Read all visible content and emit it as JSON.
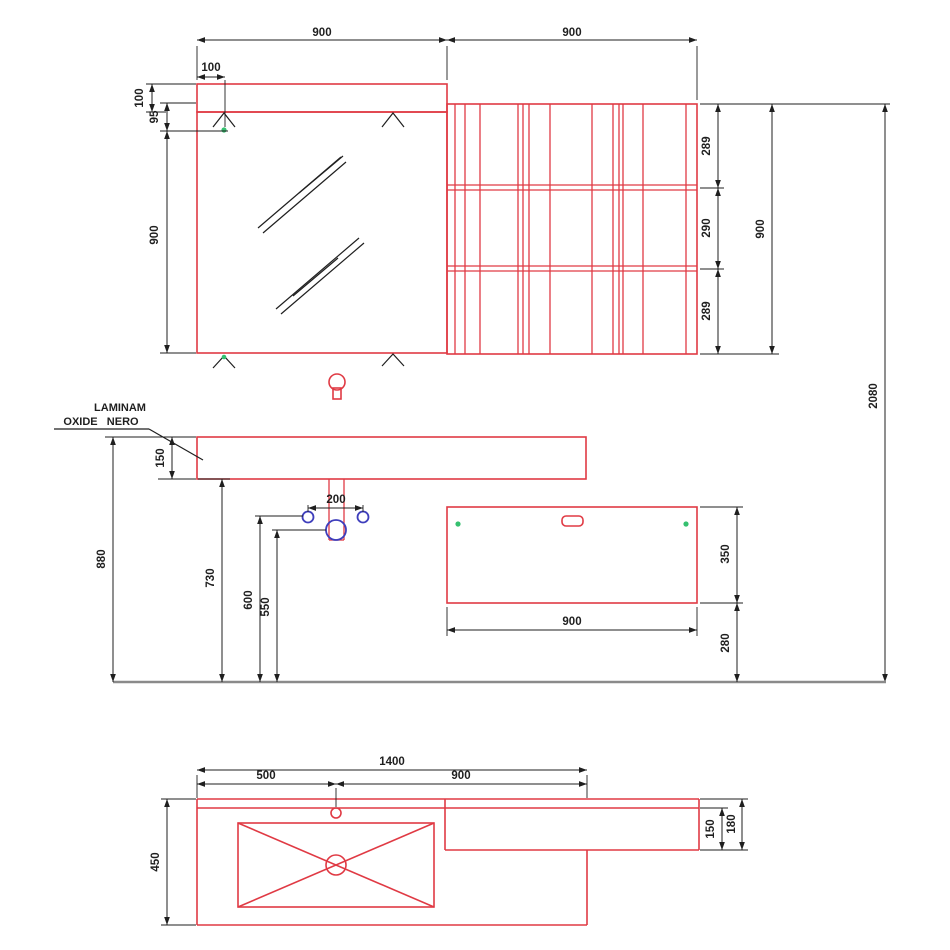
{
  "colors": {
    "red": "#e03a44",
    "blue": "#3e3ebc",
    "green": "#35c06f",
    "ink": "#1f1f1f",
    "floor": "#8a8a8a"
  },
  "material_label": {
    "line1": "LAMINAM",
    "line2": "OXIDE   NERO"
  },
  "top_view": {
    "mirror_width": "900",
    "shelf_unit_width": "900",
    "lamp_band_height": "100",
    "clip_inset_from_left": "100",
    "clip_offset_from_top": "95",
    "mirror_height": "900",
    "shelf_spacing_top": "289",
    "shelf_spacing_middle": "290",
    "shelf_spacing_bottom": "289",
    "shelf_unit_height": "900",
    "overall_height": "2080"
  },
  "front_view": {
    "countertop_thickness": "150",
    "countertop_top_height": "880",
    "countertop_bottom_height": "730",
    "water_supply_height": "600",
    "drain_height": "550",
    "water_supply_spacing": "200",
    "cabinet_width": "900",
    "cabinet_height": "350",
    "cabinet_floor_clearance": "280"
  },
  "plan_view": {
    "countertop_width": "1400",
    "basin_center_from_left": "500",
    "basin_center_to_right_edge": "900",
    "countertop_depth": "450",
    "side_shelf_inner_depth": "150",
    "side_shelf_total_depth": "180"
  }
}
